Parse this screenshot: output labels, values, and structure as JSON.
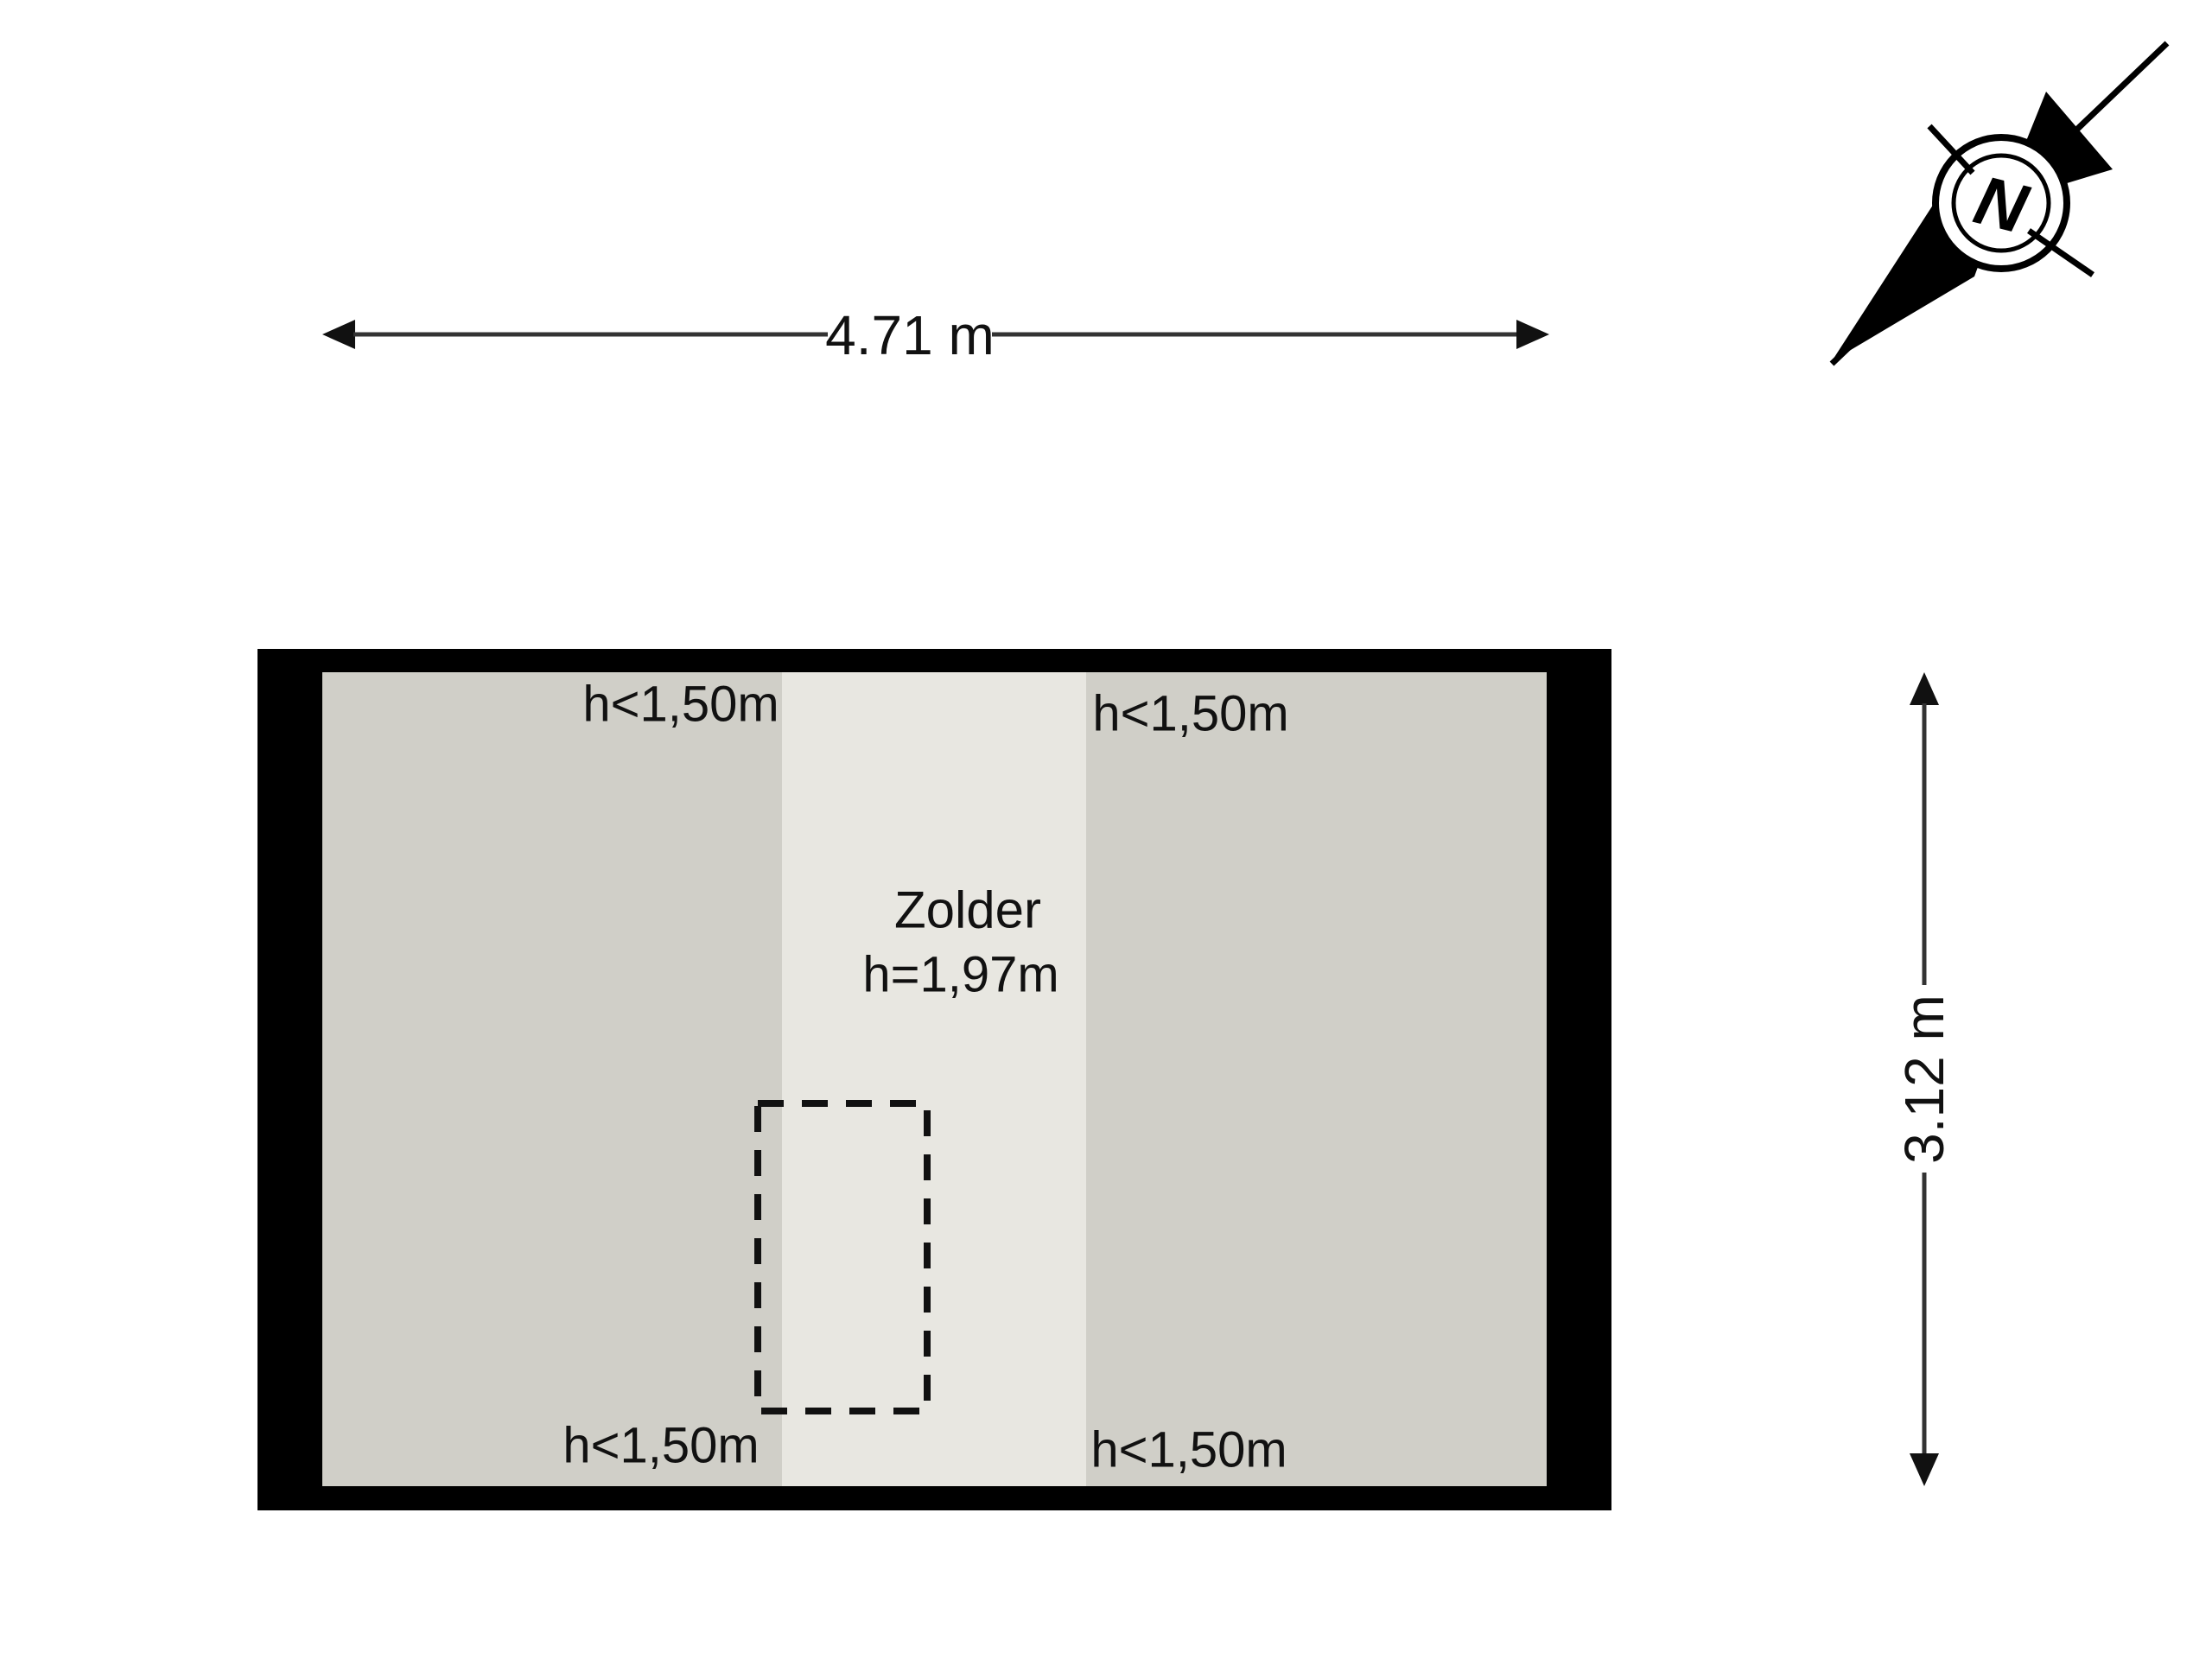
{
  "page": {
    "type": "attic floor plan",
    "background_color": "#ffffff"
  },
  "room": {
    "name": "Zolder",
    "ceiling_height_label": "h=1,97m",
    "low_headroom_labels": {
      "top_left": "h<1,50m",
      "top_right": "h<1,50m",
      "bottom_left": "h<1,50m",
      "bottom_right": "h<1,50m"
    },
    "colors": {
      "wall": "#000000",
      "low_headroom_zone": "#d0cfc8",
      "full_height_zone": "#e8e7e1",
      "stair_opening_outline": "#111111"
    }
  },
  "dimensions": {
    "width_label": "4.71 m",
    "depth_label": "3.12 m"
  },
  "compass": {
    "label": "N"
  }
}
